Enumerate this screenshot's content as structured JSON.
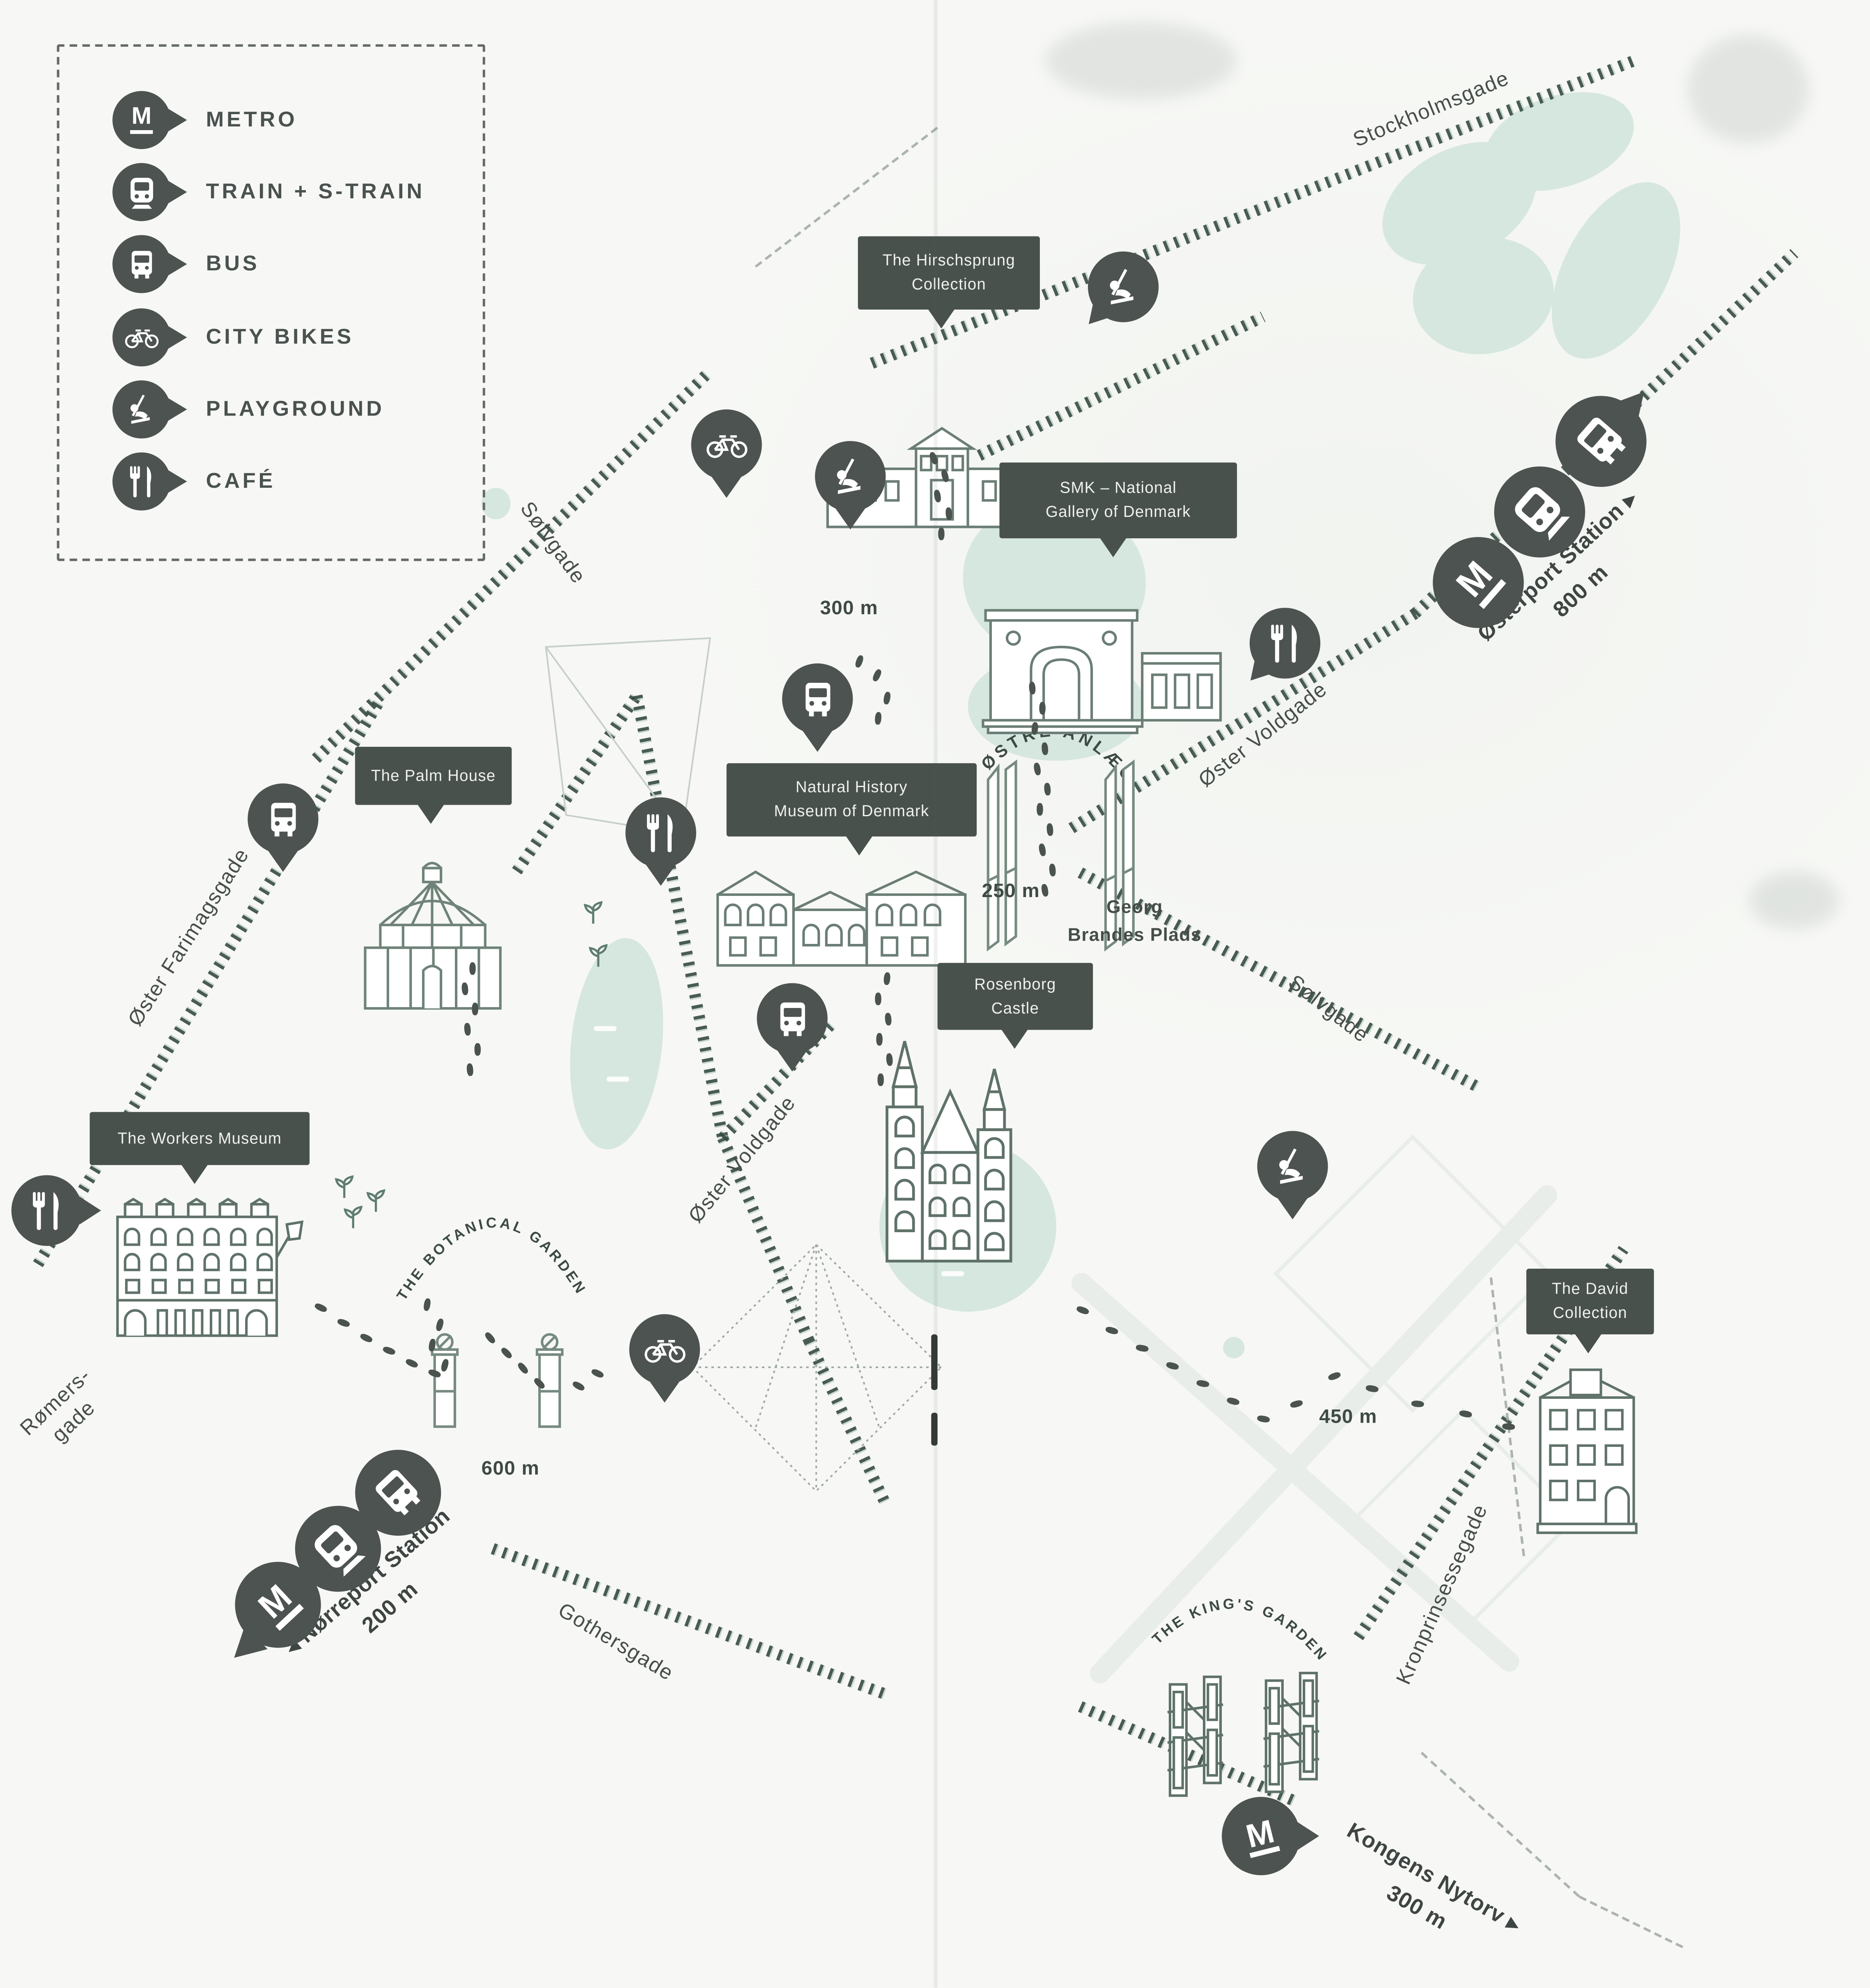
{
  "legend": {
    "items": [
      {
        "id": "metro",
        "label": "METRO",
        "icon": "metro-icon"
      },
      {
        "id": "train",
        "label": "TRAIN + S-TRAIN",
        "icon": "train-icon"
      },
      {
        "id": "bus",
        "label": "BUS",
        "icon": "bus-icon"
      },
      {
        "id": "citybikes",
        "label": "CITY BIKES",
        "icon": "bike-icon"
      },
      {
        "id": "playground",
        "label": "PLAYGROUND",
        "icon": "playground-icon"
      },
      {
        "id": "cafe",
        "label": "CAFÉ",
        "icon": "cafe-icon"
      }
    ]
  },
  "glyphs": {
    "metro": "M"
  },
  "places": {
    "hirschsprung": {
      "line1": "The Hirschsprung",
      "line2": "Collection"
    },
    "smk": {
      "line1": "SMK – National",
      "line2": "Gallery of Denmark"
    },
    "natural_history": {
      "line1": "Natural History",
      "line2": "Museum of Denmark"
    },
    "palm_house": {
      "line1": "The Palm House"
    },
    "rosenborg": {
      "line1": "Rosenborg",
      "line2": "Castle"
    },
    "workers_museum": {
      "line1": "The Workers Museum"
    },
    "david_collection": {
      "line1": "The David",
      "line2": "Collection"
    }
  },
  "streets": {
    "stockholmsgade": "Stockholmsgade",
    "solvgade_nw": "Sølvgade",
    "oster_voldgade_ne": "Øster Voldgade",
    "solvgade_e": "Sølvgade",
    "oster_farimagsgade": "Øster Farimagsgade",
    "oster_voldgade_mid": "Øster Voldgade",
    "gothersgade": "Gothersgade",
    "kronprinsessegade": "Kronprinsessegade",
    "romersgade_line1": "Rømers-",
    "romersgade_line2": "gade"
  },
  "areas": {
    "ostre_anlaeg": "ØSTRE ANLÆG",
    "botanical_garden": "THE BOTANICAL GARDEN",
    "kings_garden": "THE KING'S GARDEN",
    "georg_brandes_line1": "Georg",
    "georg_brandes_line2": "Brandes Plads"
  },
  "stations": {
    "osterport": {
      "name": "Østerport Station",
      "arrow": "▸",
      "distance": "800 m"
    },
    "norreport": {
      "name": "Nørreport Station",
      "arrow": "◂",
      "distance": "200 m"
    },
    "kongens_nytorv": {
      "name": "Kongens Nytorv",
      "arrow": "▸",
      "distance": "300 m"
    }
  },
  "distances": {
    "to_smk": "300 m",
    "to_georg_brandes": "250 m",
    "to_botanical": "600 m",
    "to_david": "450 m"
  },
  "colors": {
    "pin": "#4d5350",
    "label_bg": "#49514d",
    "mint": "#d6e7e0",
    "road": "#3c4f48",
    "building_stroke": "#6b7e75",
    "text": "#464e4b"
  }
}
